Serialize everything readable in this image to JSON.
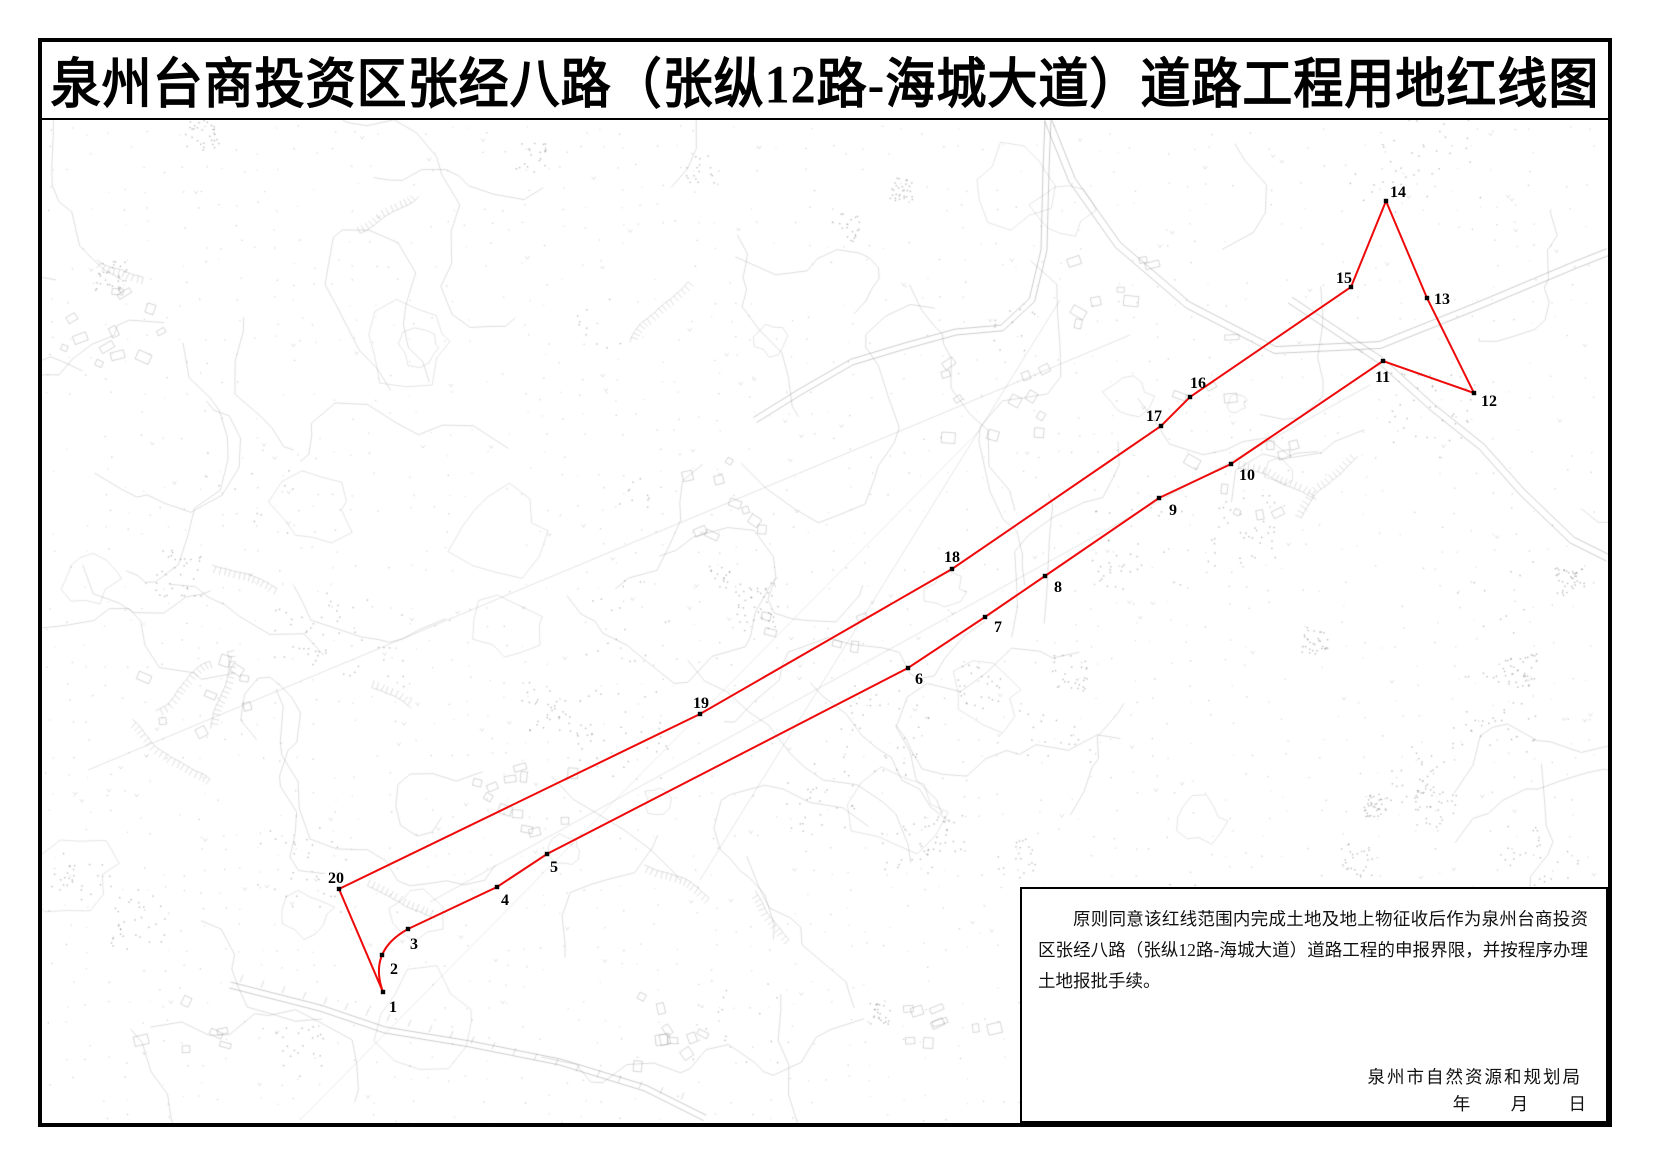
{
  "title": "泉州台商投资区张经八路（张纵12路-海城大道）道路工程用地红线图",
  "note_box": {
    "paragraph": "原则同意该红线范围内完成土地及地上物征收后作为泉州台商投资区张经八路（张纵12路-海城大道）道路工程的申报界限，并按程序办理土地报批手续。",
    "agency": "泉州市自然资源和规划局",
    "date_blanks": [
      "年",
      "月",
      "日"
    ]
  },
  "redline": {
    "color": "#ee0a0a",
    "vertex_color": "#000000",
    "stroke_width": 2,
    "closed": true,
    "curve_control_after_point1": {
      "cx": 368,
      "cy": 951
    },
    "points": [
      {
        "n": "1",
        "x": 383,
        "y": 992,
        "lx": 389,
        "ly": 1012
      },
      {
        "n": "2",
        "x": 382,
        "y": 955,
        "lx": 390,
        "ly": 974
      },
      {
        "n": "3",
        "x": 408,
        "y": 929,
        "lx": 410,
        "ly": 949
      },
      {
        "n": "4",
        "x": 497,
        "y": 887,
        "lx": 501,
        "ly": 905
      },
      {
        "n": "5",
        "x": 547,
        "y": 854,
        "lx": 550,
        "ly": 872
      },
      {
        "n": "6",
        "x": 908,
        "y": 668,
        "lx": 915,
        "ly": 684
      },
      {
        "n": "7",
        "x": 985,
        "y": 617,
        "lx": 994,
        "ly": 632
      },
      {
        "n": "8",
        "x": 1045,
        "y": 576,
        "lx": 1054,
        "ly": 592
      },
      {
        "n": "9",
        "x": 1159,
        "y": 498,
        "lx": 1169,
        "ly": 515
      },
      {
        "n": "10",
        "x": 1231,
        "y": 464,
        "lx": 1239,
        "ly": 480
      },
      {
        "n": "11",
        "x": 1383,
        "y": 361,
        "lx": 1375,
        "ly": 382
      },
      {
        "n": "12",
        "x": 1474,
        "y": 393,
        "lx": 1481,
        "ly": 406
      },
      {
        "n": "13",
        "x": 1427,
        "y": 298,
        "lx": 1434,
        "ly": 304
      },
      {
        "n": "14",
        "x": 1386,
        "y": 201,
        "lx": 1390,
        "ly": 197
      },
      {
        "n": "15",
        "x": 1351,
        "y": 287,
        "lx": 1336,
        "ly": 283
      },
      {
        "n": "16",
        "x": 1190,
        "y": 397,
        "lx": 1190,
        "ly": 388
      },
      {
        "n": "17",
        "x": 1161,
        "y": 426,
        "lx": 1146,
        "ly": 421
      },
      {
        "n": "18",
        "x": 952,
        "y": 569,
        "lx": 944,
        "ly": 562
      },
      {
        "n": "19",
        "x": 700,
        "y": 714,
        "lx": 693,
        "ly": 708
      },
      {
        "n": "20",
        "x": 339,
        "y": 889,
        "lx": 328,
        "ly": 883
      }
    ]
  }
}
